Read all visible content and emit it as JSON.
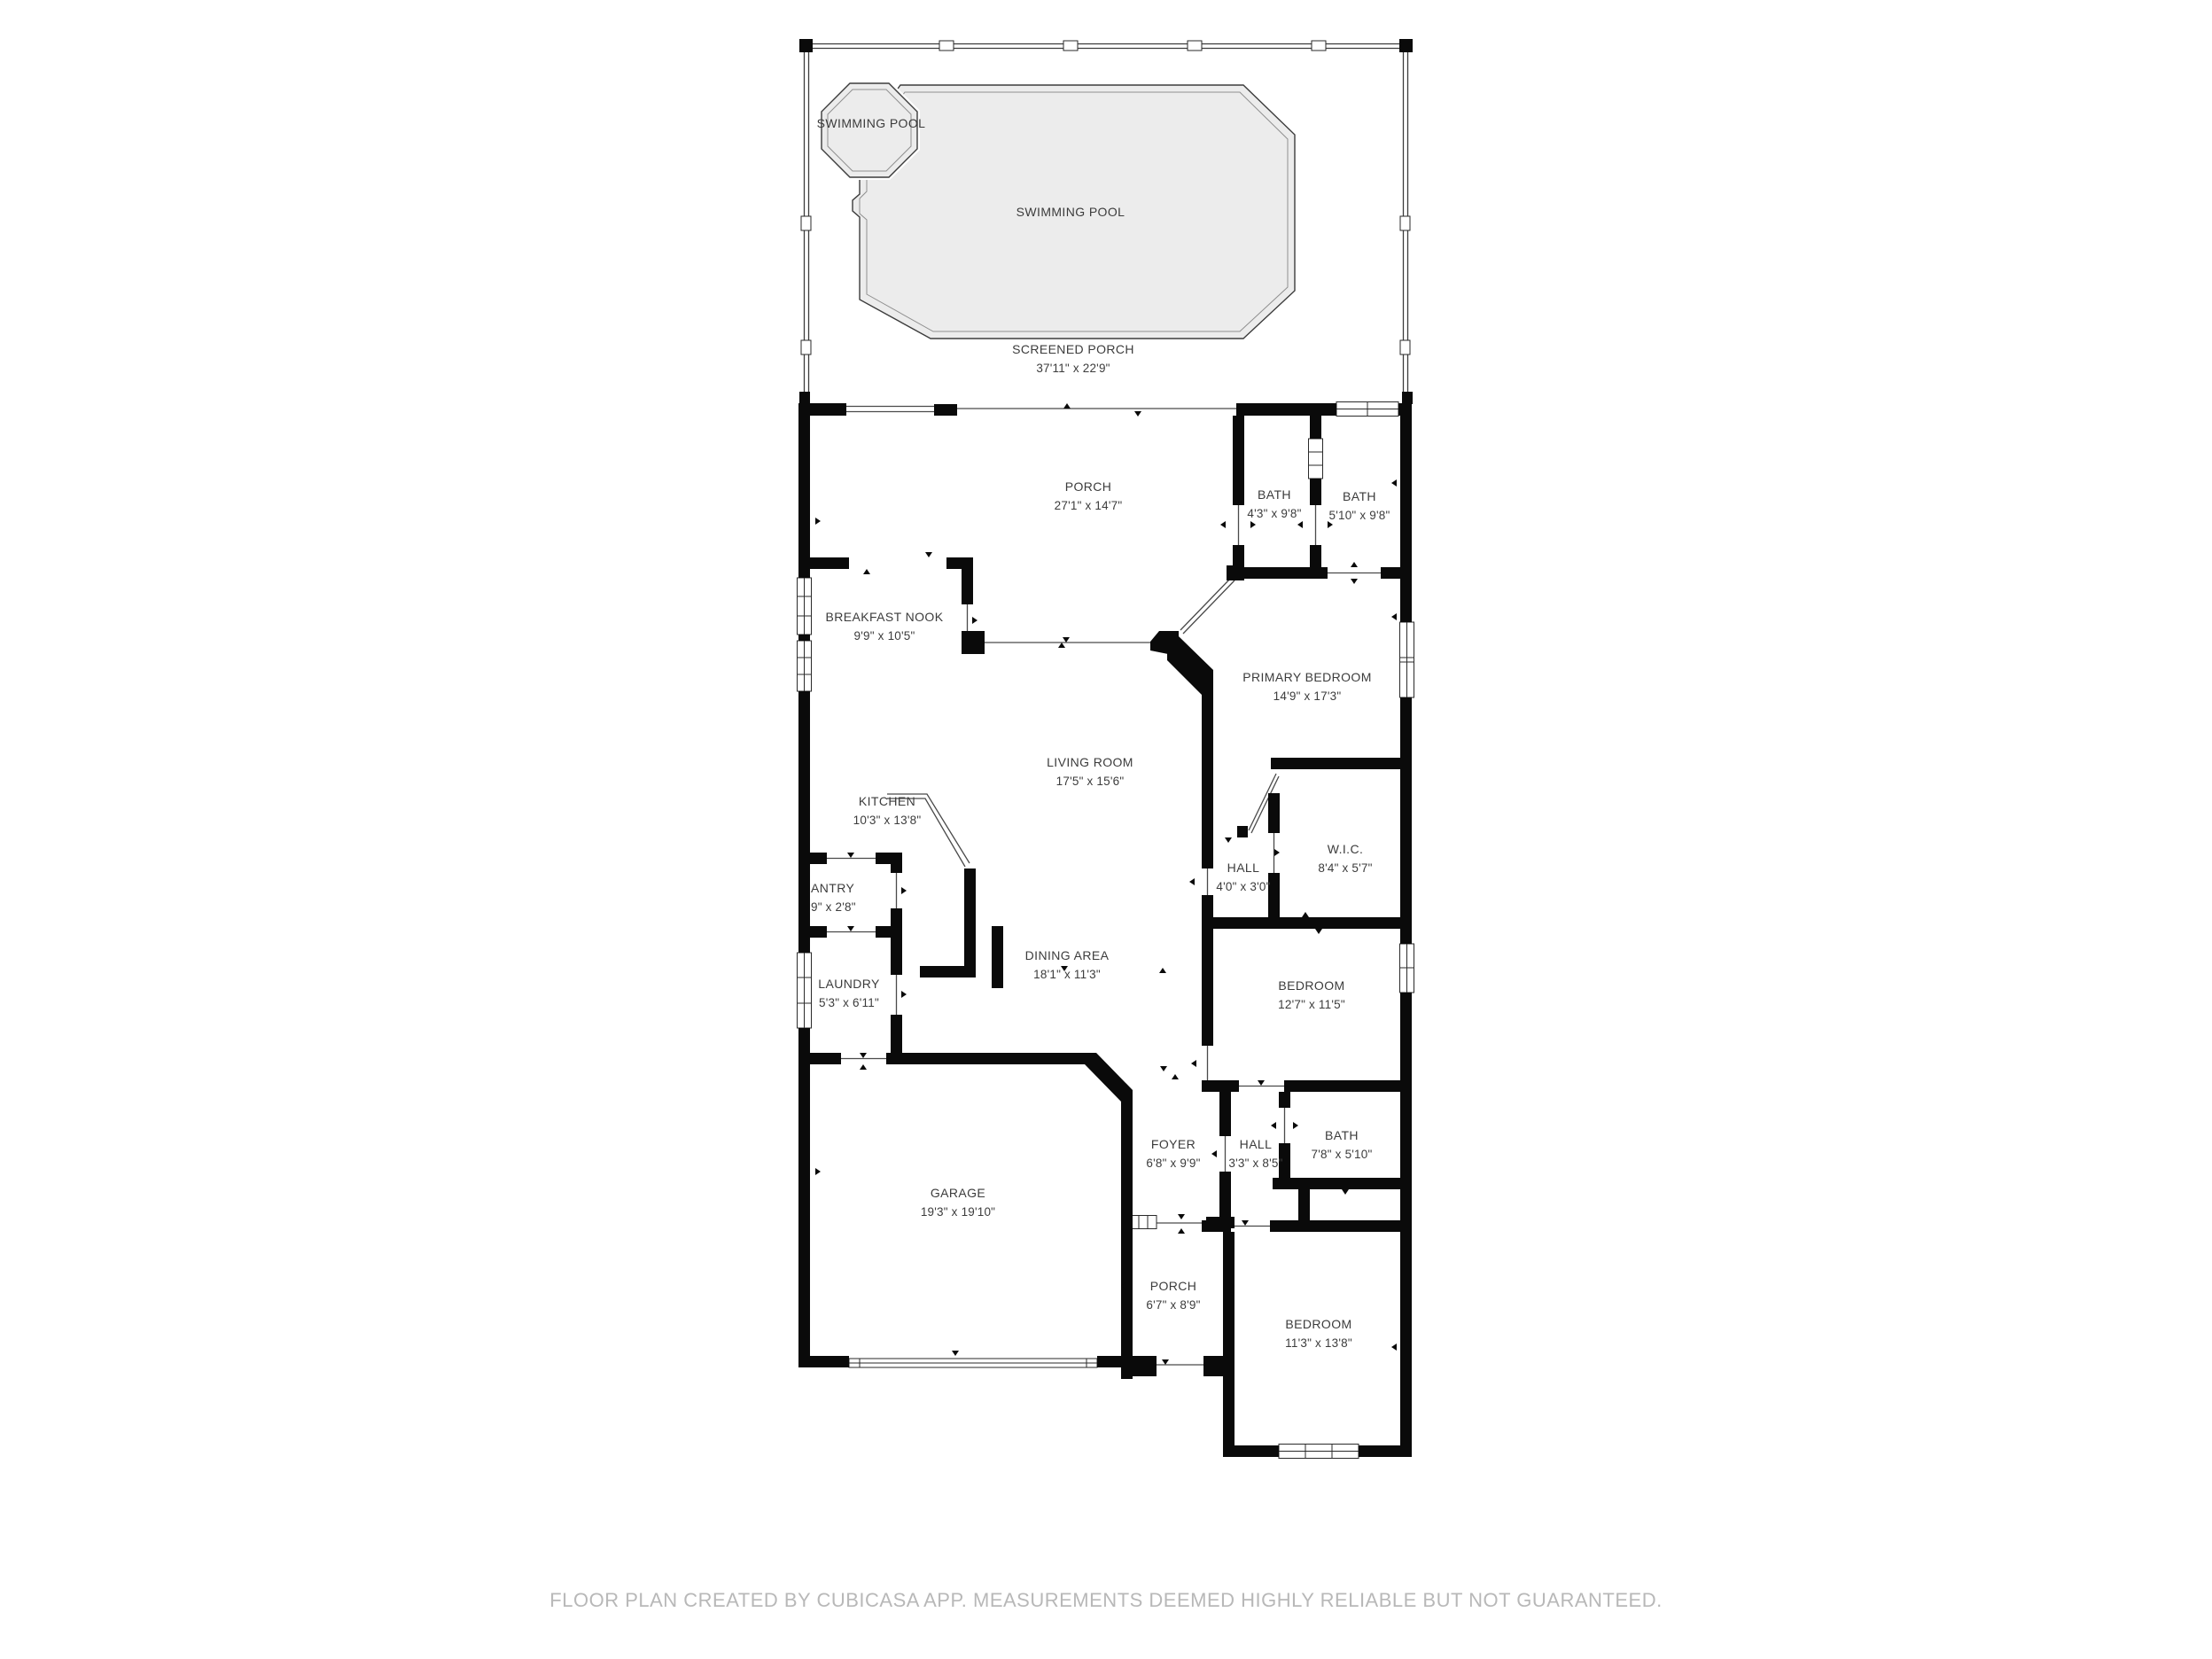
{
  "colors": {
    "wall": "#0a0a0a",
    "pool_fill": "#ececec",
    "thin_line": "#4a4a4a",
    "label_text": "#3c3c3c",
    "footer_text": "#b8b8b8",
    "background": "#ffffff"
  },
  "plan": {
    "rooms": [
      {
        "id": "swimming-pool-spa",
        "name": "SWIMMING POOL",
        "dims": ""
      },
      {
        "id": "swimming-pool",
        "name": "SWIMMING POOL",
        "dims": ""
      },
      {
        "id": "screened-porch",
        "name": "SCREENED PORCH",
        "dims": "37'11\" x 22'9\""
      },
      {
        "id": "porch-top",
        "name": "PORCH",
        "dims": "27'1\" x 14'7\""
      },
      {
        "id": "bath-1",
        "name": "BATH",
        "dims": "4'3\" x 9'8\""
      },
      {
        "id": "bath-2",
        "name": "BATH",
        "dims": "5'10\" x 9'8\""
      },
      {
        "id": "breakfast-nook",
        "name": "BREAKFAST NOOK",
        "dims": "9'9\" x 10'5\""
      },
      {
        "id": "primary-bedroom",
        "name": "PRIMARY BEDROOM",
        "dims": "14'9\" x 17'3\""
      },
      {
        "id": "living-room",
        "name": "LIVING ROOM",
        "dims": "17'5\" x 15'6\""
      },
      {
        "id": "kitchen",
        "name": "KITCHEN",
        "dims": "10'3\" x 13'8\""
      },
      {
        "id": "wic",
        "name": "W.I.C.",
        "dims": "8'4\" x 5'7\""
      },
      {
        "id": "hall-primary",
        "name": "HALL",
        "dims": "4'0\" x 3'0\""
      },
      {
        "id": "pantry",
        "name": "ANTRY",
        "dims": "9\" x 2'8\""
      },
      {
        "id": "laundry",
        "name": "LAUNDRY",
        "dims": "5'3\" x 6'11\""
      },
      {
        "id": "dining-area",
        "name": "DINING AREA",
        "dims": "18'1\" x 11'3\""
      },
      {
        "id": "bedroom-mid",
        "name": "BEDROOM",
        "dims": "12'7\" x 11'5\""
      },
      {
        "id": "foyer",
        "name": "FOYER",
        "dims": "6'8\" x 9'9\""
      },
      {
        "id": "hall-2",
        "name": "HALL",
        "dims": "3'3\" x 8'5\""
      },
      {
        "id": "bath-3",
        "name": "BATH",
        "dims": "7'8\" x 5'10\""
      },
      {
        "id": "garage",
        "name": "GARAGE",
        "dims": "19'3\" x 19'10\""
      },
      {
        "id": "porch-bottom",
        "name": "PORCH",
        "dims": "6'7\" x 8'9\""
      },
      {
        "id": "bedroom-bottom",
        "name": "BEDROOM",
        "dims": "11'3\" x 13'8\""
      }
    ]
  },
  "footer": {
    "text": "FLOOR PLAN CREATED BY CUBICASA APP. MEASUREMENTS DEEMED HIGHLY RELIABLE BUT NOT GUARANTEED."
  }
}
